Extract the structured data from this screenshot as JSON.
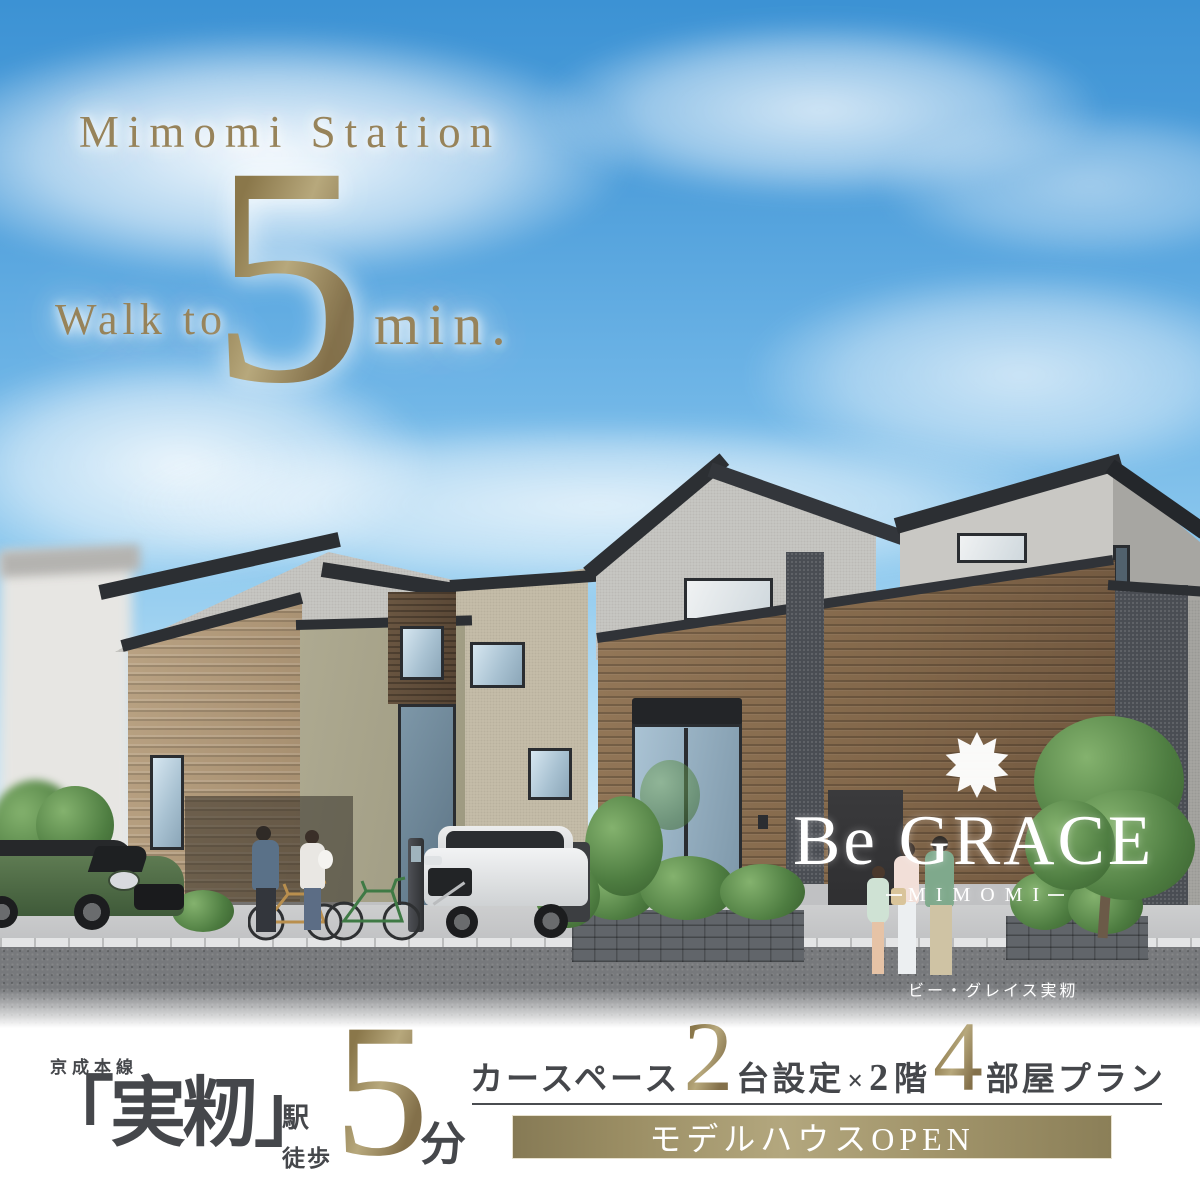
{
  "hero": {
    "station_en": "Mimomi Station",
    "walk_prefix": "Walk to",
    "minutes": "5",
    "minutes_unit_en": "min."
  },
  "logo": {
    "brand": "Be GRACE",
    "location": "MIMOMI",
    "reading": "ビー・グレイス実籾",
    "ornament_icon": "diamond-ornament-icon"
  },
  "info_bar": {
    "rail_line": "京成本線",
    "station_name": "「実籾」",
    "station_word": "駅",
    "walk_word": "徒歩",
    "minutes": "5",
    "minutes_unit": "分",
    "plan": {
      "s1": "カースペース",
      "n1": "2",
      "s2": "台設定",
      "s3": "×",
      "s4": "2",
      "s5": "階",
      "n2": "4",
      "s6": "部屋プラン"
    },
    "banner": "モデルハウスOPEN"
  },
  "colors": {
    "gold": "#97835a",
    "gold_light": "#b7a87c",
    "text_dark": "#45474b",
    "banner_gold_mid": "#b3a77e",
    "banner_gold_edge": "#867a55",
    "sky_top": "#3c92d4",
    "wood_brown": "#82674a",
    "wall_gray": "#c9c8c4",
    "roof_dark": "#2c2f33",
    "logo_white": "#ffffff"
  }
}
